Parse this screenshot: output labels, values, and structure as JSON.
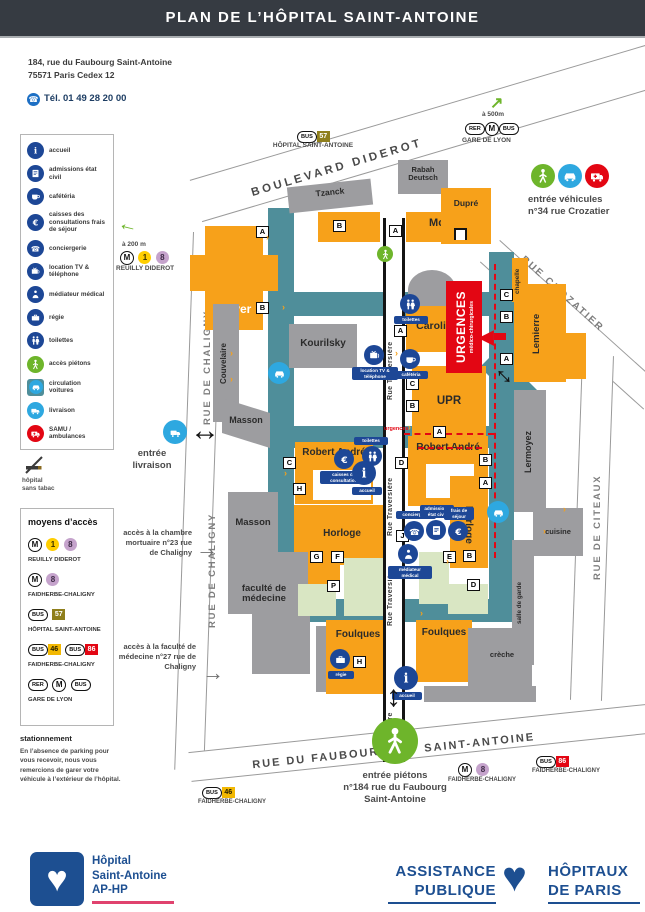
{
  "header": {
    "title": "PLAN DE L’HÔPITAL SAINT-ANTOINE"
  },
  "contact": {
    "address1": "184, rue du Faubourg Saint-Antoine",
    "address2": "75571 Paris Cedex 12",
    "phone": "Tél. 01 49 28 20 00"
  },
  "legend": {
    "items": [
      {
        "label": "accueil"
      },
      {
        "label": "admissions état civil"
      },
      {
        "label": "cafétéria"
      },
      {
        "label": "caisses des consultations frais de séjour"
      },
      {
        "label": "conciergerie"
      },
      {
        "label": "location TV & téléphone"
      },
      {
        "label": "médiateur médical"
      },
      {
        "label": "régie"
      },
      {
        "label": "toilettes"
      },
      {
        "label": "accès piétons"
      },
      {
        "label": "circulation voitures"
      },
      {
        "label": "livraison"
      },
      {
        "label": "SAMU / ambulances"
      }
    ]
  },
  "no_smoking": {
    "line1": "hôpital",
    "line2": "sans tabac"
  },
  "access": {
    "title": "moyens d’accès",
    "rows": [
      {
        "m": "M",
        "l1": "1",
        "l2": "8",
        "label": "REUILLY DIDEROT"
      },
      {
        "m": "M",
        "l1": "8",
        "label": "FAIDHERBE-CHALIGNY"
      },
      {
        "b": "BUS",
        "n": "57",
        "label": "HÔPITAL SAINT-ANTOINE"
      },
      {
        "b1": "BUS",
        "n1": "46",
        "b2": "BUS",
        "n2": "86",
        "label": "FAIDHERBE-CHALIGNY"
      },
      {
        "r": "RER",
        "m": "M",
        "b": "BUS",
        "label": "GARE DE LYON"
      }
    ]
  },
  "parking": {
    "title": "stationnement",
    "text": "En l’absence de parking pour vous recevoir, nous vous remercions de garer votre véhicule à l’extérieur de l’hôpital."
  },
  "map": {
    "streets": {
      "diderot": "BOULEVARD DIDEROT",
      "chaligny": "RUE DE CHALIGNY",
      "crozatier": "RUE CROZATIER",
      "citeaux": "RUE DE CITEAUX",
      "faubourg1": "RUE DU FAUBOURG",
      "faubourg2": "SAINT-ANTOINE",
      "traversiere": "Rue Traversière",
      "traversiere_short": "Traversière"
    },
    "stops": {
      "bus57": {
        "badge": "BUS",
        "line": "57",
        "name": "HÔPITAL SAINT-ANTOINE"
      },
      "gare": {
        "dist": "à 500m",
        "rer": "RER",
        "m": "M",
        "bus": "BUS",
        "name": "GARE DE LYON"
      },
      "reuilly": {
        "dist": "à 200 m",
        "m": "M",
        "l1": "1",
        "l2": "8",
        "name": "REUILLY DIDEROT"
      },
      "m8": {
        "m": "M",
        "l": "8",
        "name": "FAIDHERBE-CHALIGNY"
      },
      "bus86": {
        "badge": "BUS",
        "line": "86",
        "name": "FAIDHERBE-CHALIGNY"
      },
      "bus46": {
        "badge": "BUS",
        "line": "46",
        "name": "FAIDHERBE-CHALIGNY"
      }
    },
    "entrances": {
      "vehicles1": "entrée véhicules",
      "vehicles2": "n°34 rue Crozatier",
      "delivery1": "entrée",
      "delivery2": "livraison",
      "mortuary": "accès à la chambre mortuaire n°23 rue de Chaligny",
      "faculty": "accès à la faculté de médecine n°27 rue de Chaligny",
      "ped1": "entrée piétons",
      "ped2": "n°184 rue du Faubourg",
      "ped3": "Saint-Antoine"
    },
    "urgences": {
      "title": "URGENCES",
      "subtitle": "médico-chirurgicales",
      "path_label": "urgences"
    },
    "buildings": [
      {
        "label": "Mayer"
      },
      {
        "label": "Moïana"
      },
      {
        "label": "Tzanck"
      },
      {
        "label": "Rabah Deutsch"
      },
      {
        "label": "Dupré"
      },
      {
        "label": "Caroli"
      },
      {
        "label": "Kourilsky"
      },
      {
        "label": "Couvelaire"
      },
      {
        "label": "Masson"
      },
      {
        "label": "Masson"
      },
      {
        "label": "UPR"
      },
      {
        "label": "Lemierre"
      },
      {
        "label": "chapelle"
      },
      {
        "label": "Lermoyez"
      },
      {
        "label": "Robert André"
      },
      {
        "label": "Robert André"
      },
      {
        "label": "Horloge"
      },
      {
        "label": "Horloge"
      },
      {
        "label": "cuisine"
      },
      {
        "label": "salle de garde"
      },
      {
        "label": "faculté de médecine"
      },
      {
        "label": "Foulques"
      },
      {
        "label": "Foulques"
      },
      {
        "label": "crèche"
      }
    ],
    "letters": [
      "A",
      "B",
      "A",
      "B",
      "A",
      "C",
      "B",
      "A",
      "C",
      "B",
      "A",
      "C",
      "H",
      "D",
      "B",
      "A",
      "G",
      "F",
      "P",
      "J",
      "E",
      "B",
      "D",
      "H"
    ],
    "poi": {
      "toilettes1": "toilettes",
      "cafeteria": "cafétéria",
      "location": "location TV & téléphone",
      "caisses": "caisses des consultations",
      "toilettes2": "toilettes",
      "accueil1": "accueil",
      "conciergerie": "conciergerie",
      "admissions": "admissions état civil",
      "frais": "frais de séjour",
      "mediateur": "médiateur médical",
      "regie": "régie",
      "accueil2": "accueil"
    }
  },
  "footer": {
    "hospital": {
      "line1": "Hôpital",
      "line2": "Saint-Antoine",
      "line3": "AP-HP"
    },
    "aphp": {
      "w1": "ASSISTANCE",
      "w2": "PUBLIQUE",
      "w3": "HÔPITAUX",
      "w4": "DE PARIS"
    }
  }
}
